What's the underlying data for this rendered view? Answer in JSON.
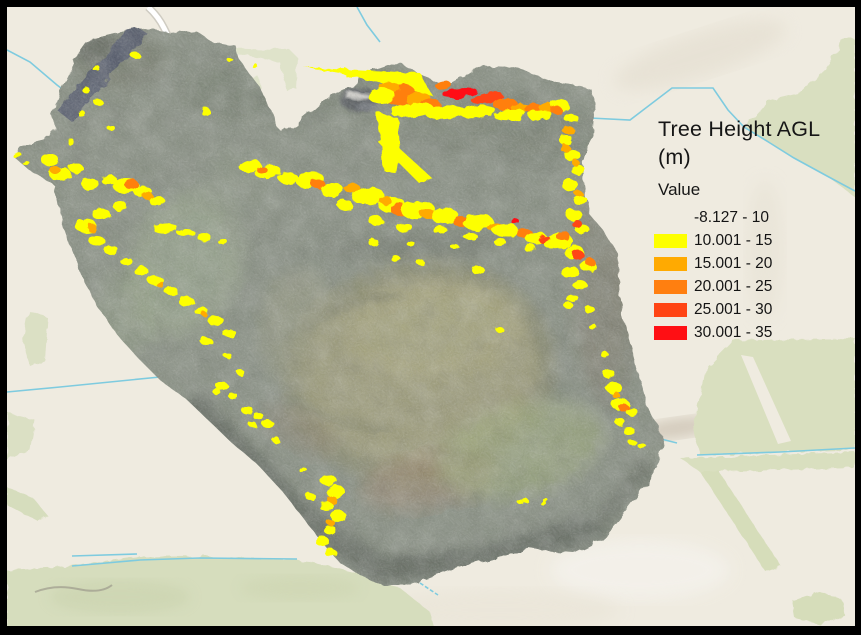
{
  "legend": {
    "title": "Tree Height AGL (m)",
    "title_lines": [
      "Tree Height AGL",
      "(m)"
    ],
    "field_label": "Value",
    "classes": [
      {
        "label": "-8.127 - 10",
        "color": "none"
      },
      {
        "label": "10.001 - 15",
        "color": "#fdff00"
      },
      {
        "label": "15.001 - 20",
        "color": "#ffaa01"
      },
      {
        "label": "20.001 - 25",
        "color": "#ff7f10"
      },
      {
        "label": "25.001 - 30",
        "color": "#ff4414"
      },
      {
        "label": "30.001 - 35",
        "color": "#ff0f14"
      }
    ]
  },
  "map": {
    "colors": {
      "frame": "#000000",
      "basemap": "#efebe0",
      "fields_green": "#dce1c3",
      "water_pond": "#a9dcf0",
      "stream": "#7ecbdf",
      "road": "#ffffff"
    },
    "overlay": {
      "format": "patches: [classIndex, cx, cy, rx, ry, rotateDeg]; spikes: yellow polygons (class 1)",
      "spikes": [
        "303,67 420,73 432,95 415,92 340,73",
        "345,68 362,74 346,77",
        "376,112 398,118 400,150 396,174 383,170 381,140",
        "378,142 388,138 432,178 420,184"
      ],
      "patches": [
        [
          3,
          400,
          95,
          16,
          10,
          -10
        ],
        [
          2,
          390,
          88,
          10,
          6,
          0
        ],
        [
          1,
          382,
          96,
          14,
          8,
          0
        ],
        [
          2,
          418,
          99,
          12,
          7,
          -8
        ],
        [
          3,
          430,
          104,
          10,
          6,
          0
        ],
        [
          5,
          460,
          93,
          17,
          5,
          -8
        ],
        [
          4,
          487,
          98,
          16,
          6,
          -10
        ],
        [
          3,
          505,
          104,
          12,
          6,
          -5
        ],
        [
          2,
          520,
          108,
          10,
          5,
          0
        ],
        [
          3,
          533,
          108,
          9,
          5,
          0
        ],
        [
          2,
          547,
          108,
          8,
          5,
          0
        ],
        [
          1,
          412,
          110,
          22,
          7,
          -5
        ],
        [
          1,
          445,
          112,
          20,
          7,
          -5
        ],
        [
          1,
          478,
          112,
          18,
          6,
          -5
        ],
        [
          1,
          510,
          115,
          16,
          6,
          -5
        ],
        [
          1,
          540,
          115,
          12,
          5,
          -5
        ],
        [
          1,
          560,
          105,
          9,
          6,
          0
        ],
        [
          3,
          556,
          110,
          6,
          4,
          0
        ],
        [
          1,
          571,
          118,
          7,
          5,
          0
        ],
        [
          2,
          568,
          130,
          6,
          4,
          0
        ],
        [
          1,
          566,
          140,
          7,
          5,
          0
        ],
        [
          2,
          565,
          148,
          5,
          4,
          0
        ],
        [
          3,
          443,
          85,
          8,
          4,
          -8
        ],
        [
          1,
          572,
          155,
          8,
          6,
          0
        ],
        [
          1,
          578,
          170,
          7,
          5,
          0
        ],
        [
          2,
          576,
          163,
          4,
          3,
          0
        ],
        [
          1,
          570,
          185,
          8,
          6,
          0
        ],
        [
          1,
          580,
          200,
          7,
          5,
          0
        ],
        [
          2,
          578,
          193,
          4,
          3,
          0
        ],
        [
          1,
          574,
          215,
          8,
          6,
          0
        ],
        [
          1,
          583,
          230,
          7,
          5,
          0
        ],
        [
          4,
          577,
          224,
          5,
          4,
          0
        ],
        [
          1,
          560,
          240,
          12,
          8,
          0
        ],
        [
          3,
          563,
          236,
          7,
          5,
          0
        ],
        [
          1,
          574,
          252,
          10,
          7,
          0
        ],
        [
          4,
          578,
          255,
          6,
          5,
          0
        ],
        [
          1,
          588,
          266,
          8,
          6,
          0
        ],
        [
          3,
          590,
          262,
          5,
          4,
          0
        ],
        [
          1,
          570,
          272,
          9,
          6,
          0
        ],
        [
          1,
          580,
          285,
          7,
          5,
          0
        ],
        [
          1,
          572,
          298,
          6,
          4,
          0
        ],
        [
          1,
          590,
          310,
          5,
          4,
          0
        ],
        [
          1,
          568,
          305,
          5,
          3,
          0
        ],
        [
          1,
          593,
          327,
          4,
          3,
          0
        ],
        [
          1,
          250,
          166,
          11,
          6,
          -10
        ],
        [
          1,
          268,
          172,
          13,
          7,
          -8
        ],
        [
          3,
          262,
          170,
          5,
          4,
          0
        ],
        [
          1,
          288,
          178,
          10,
          6,
          0
        ],
        [
          1,
          310,
          180,
          14,
          8,
          -8
        ],
        [
          3,
          318,
          184,
          7,
          5,
          0
        ],
        [
          1,
          332,
          190,
          12,
          7,
          0
        ],
        [
          2,
          352,
          188,
          8,
          5,
          0
        ],
        [
          1,
          368,
          196,
          16,
          9,
          -5
        ],
        [
          1,
          392,
          205,
          14,
          8,
          0
        ],
        [
          3,
          400,
          210,
          9,
          6,
          0
        ],
        [
          1,
          418,
          210,
          17,
          9,
          -5
        ],
        [
          2,
          428,
          214,
          8,
          5,
          0
        ],
        [
          1,
          445,
          216,
          14,
          8,
          0
        ],
        [
          3,
          462,
          222,
          9,
          5,
          0
        ],
        [
          1,
          478,
          222,
          15,
          8,
          -5
        ],
        [
          2,
          495,
          227,
          8,
          5,
          0
        ],
        [
          1,
          505,
          230,
          13,
          7,
          0
        ],
        [
          5,
          516,
          222,
          4,
          3,
          0
        ],
        [
          3,
          524,
          233,
          8,
          5,
          0
        ],
        [
          1,
          536,
          238,
          11,
          6,
          0
        ],
        [
          4,
          545,
          240,
          6,
          4,
          0
        ],
        [
          1,
          552,
          244,
          8,
          5,
          0
        ],
        [
          1,
          345,
          205,
          8,
          5,
          0
        ],
        [
          1,
          375,
          220,
          7,
          5,
          0
        ],
        [
          1,
          405,
          228,
          8,
          5,
          0
        ],
        [
          1,
          440,
          230,
          7,
          4,
          0
        ],
        [
          1,
          470,
          236,
          7,
          4,
          0
        ],
        [
          1,
          500,
          242,
          6,
          4,
          0
        ],
        [
          1,
          530,
          248,
          6,
          4,
          0
        ],
        [
          2,
          385,
          200,
          6,
          4,
          0
        ],
        [
          1,
          395,
          258,
          5,
          3,
          0
        ],
        [
          1,
          420,
          262,
          4,
          3,
          0
        ],
        [
          1,
          455,
          247,
          4,
          3,
          0
        ],
        [
          1,
          478,
          270,
          6,
          5,
          0
        ],
        [
          1,
          500,
          330,
          4,
          3,
          0
        ],
        [
          1,
          373,
          242,
          5,
          4,
          0
        ],
        [
          1,
          410,
          243,
          4,
          3,
          0
        ],
        [
          1,
          50,
          160,
          9,
          6,
          0
        ],
        [
          1,
          60,
          174,
          11,
          7,
          0
        ],
        [
          2,
          55,
          170,
          5,
          4,
          0
        ],
        [
          1,
          76,
          168,
          7,
          5,
          0
        ],
        [
          1,
          90,
          184,
          9,
          6,
          0
        ],
        [
          1,
          109,
          180,
          8,
          5,
          0
        ],
        [
          1,
          126,
          186,
          13,
          8,
          0
        ],
        [
          3,
          131,
          184,
          7,
          5,
          0
        ],
        [
          1,
          143,
          192,
          9,
          6,
          0
        ],
        [
          2,
          148,
          196,
          5,
          4,
          0
        ],
        [
          1,
          157,
          201,
          8,
          5,
          0
        ],
        [
          1,
          120,
          206,
          7,
          5,
          0
        ],
        [
          1,
          101,
          214,
          9,
          6,
          0
        ],
        [
          1,
          86,
          226,
          11,
          7,
          0
        ],
        [
          2,
          92,
          228,
          5,
          4,
          0
        ],
        [
          1,
          97,
          241,
          8,
          5,
          0
        ],
        [
          1,
          111,
          250,
          7,
          5,
          0
        ],
        [
          1,
          126,
          261,
          6,
          4,
          0
        ],
        [
          1,
          141,
          271,
          7,
          5,
          0
        ],
        [
          1,
          156,
          281,
          8,
          5,
          0
        ],
        [
          2,
          160,
          284,
          4,
          3,
          0
        ],
        [
          1,
          171,
          291,
          7,
          4,
          0
        ],
        [
          1,
          186,
          301,
          8,
          5,
          0
        ],
        [
          1,
          201,
          311,
          7,
          4,
          0
        ],
        [
          2,
          204,
          314,
          3,
          2,
          0
        ],
        [
          1,
          216,
          321,
          8,
          5,
          0
        ],
        [
          1,
          229,
          333,
          7,
          4,
          0
        ],
        [
          1,
          206,
          341,
          6,
          4,
          0
        ],
        [
          1,
          165,
          228,
          12,
          5,
          -5
        ],
        [
          1,
          185,
          232,
          9,
          4,
          0
        ],
        [
          1,
          204,
          237,
          7,
          4,
          0
        ],
        [
          1,
          222,
          241,
          5,
          3,
          0
        ],
        [
          1,
          135,
          55,
          5,
          3,
          0
        ],
        [
          1,
          96,
          68,
          4,
          3,
          0
        ],
        [
          1,
          86,
          90,
          4,
          3,
          0
        ],
        [
          1,
          98,
          102,
          5,
          3,
          0
        ],
        [
          1,
          81,
          113,
          4,
          3,
          0
        ],
        [
          1,
          111,
          128,
          4,
          3,
          0
        ],
        [
          1,
          71,
          142,
          4,
          3,
          0
        ],
        [
          1,
          17,
          155,
          5,
          3,
          0
        ],
        [
          1,
          26,
          163,
          4,
          2,
          0
        ],
        [
          1,
          205,
          111,
          5,
          4,
          0
        ],
        [
          1,
          230,
          60,
          3,
          2,
          0
        ],
        [
          1,
          255,
          66,
          3,
          2,
          0
        ],
        [
          1,
          222,
          386,
          6,
          4,
          0
        ],
        [
          1,
          233,
          396,
          5,
          3,
          0
        ],
        [
          1,
          247,
          410,
          6,
          4,
          0
        ],
        [
          1,
          258,
          416,
          5,
          4,
          0
        ],
        [
          1,
          268,
          424,
          6,
          4,
          0
        ],
        [
          1,
          276,
          440,
          4,
          3,
          0
        ],
        [
          1,
          240,
          372,
          4,
          3,
          0
        ],
        [
          1,
          228,
          356,
          4,
          3,
          0
        ],
        [
          1,
          216,
          391,
          4,
          3,
          0
        ],
        [
          1,
          253,
          425,
          4,
          3,
          0
        ],
        [
          1,
          328,
          480,
          8,
          6,
          0
        ],
        [
          1,
          336,
          492,
          9,
          7,
          0
        ],
        [
          2,
          332,
          500,
          5,
          4,
          0
        ],
        [
          1,
          326,
          506,
          7,
          5,
          0
        ],
        [
          1,
          338,
          516,
          8,
          6,
          0
        ],
        [
          2,
          330,
          522,
          4,
          3,
          0
        ],
        [
          1,
          330,
          530,
          6,
          5,
          0
        ],
        [
          1,
          322,
          541,
          7,
          5,
          0
        ],
        [
          1,
          331,
          553,
          6,
          4,
          0
        ],
        [
          1,
          310,
          496,
          5,
          4,
          0
        ],
        [
          1,
          303,
          470,
          4,
          3,
          0
        ],
        [
          1,
          609,
          374,
          6,
          5,
          0
        ],
        [
          1,
          614,
          388,
          8,
          6,
          0
        ],
        [
          2,
          616,
          395,
          4,
          3,
          0
        ],
        [
          1,
          620,
          404,
          9,
          6,
          0
        ],
        [
          3,
          624,
          408,
          5,
          4,
          0
        ],
        [
          1,
          632,
          412,
          6,
          4,
          0
        ],
        [
          1,
          620,
          422,
          5,
          4,
          0
        ],
        [
          1,
          629,
          431,
          6,
          4,
          0
        ],
        [
          1,
          642,
          446,
          4,
          3,
          0
        ],
        [
          1,
          633,
          443,
          4,
          3,
          0
        ],
        [
          1,
          605,
          355,
          4,
          3,
          0
        ],
        [
          1,
          525,
          500,
          3,
          2,
          0
        ],
        [
          1,
          545,
          500,
          3,
          2,
          0
        ],
        [
          1,
          520,
          502,
          3,
          2,
          0
        ],
        [
          1,
          543,
          503,
          3,
          2,
          0
        ]
      ]
    }
  }
}
